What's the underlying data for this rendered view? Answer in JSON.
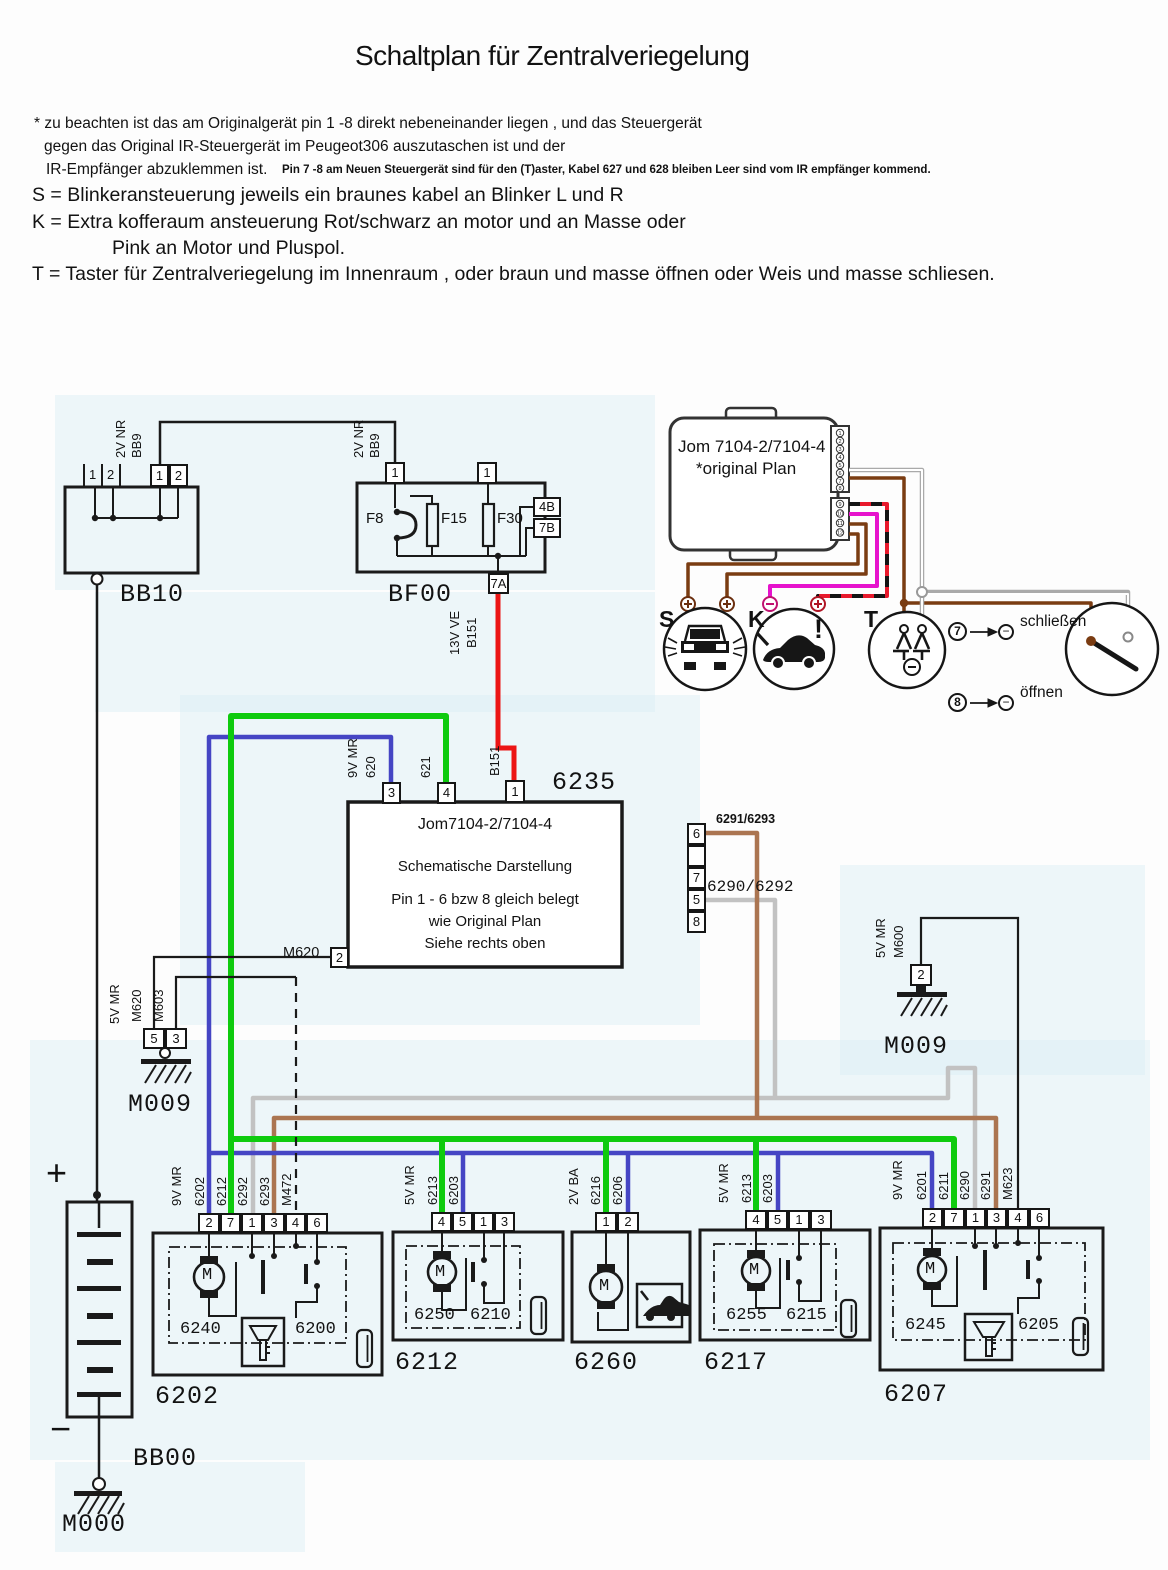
{
  "header": {
    "title": "Schaltplan für Zentralveriegelung",
    "note1": "* zu beachten ist das am Originalgerät pin 1 -8 direkt nebeneinander liegen , und das Steuergerät",
    "note2": "gegen das Original IR-Steuergerät im Peugeot306 auszutaschen ist und der",
    "note3": "IR-Empfänger abzuklemmen ist.",
    "note3b": "Pin 7 -8 am Neuen Steuergerät sind für den (T)aster, Kabel 627 und 628 bleiben Leer sind vom IR empfänger kommend.",
    "s_line": "S = Blinkeransteuerung jeweils ein braunes kabel an Blinker L und R",
    "k_line1": "K = Extra kofferaum ansteuerung Rot/schwarz an motor und an Masse oder",
    "k_line2": "Pink an Motor und  Pluspol.",
    "t_line": "T = Taster für Zentralveriegelung im Innenraum , oder braun und masse öffnen oder Weis und masse schliesen."
  },
  "bb10": {
    "label": "BB10",
    "tick1": "1",
    "tick2": "2",
    "pin1": "1",
    "pin2": "2",
    "w1": "2V NR",
    "w2": "BB9"
  },
  "bf00": {
    "label": "BF00",
    "f8": "F8",
    "f15": "F15",
    "f30": "F30",
    "pin_l": "1",
    "pin_r": "1",
    "p4b": "4B",
    "p7b": "7B",
    "p7a": "7A",
    "w1": "2V NR",
    "w2": "BB9",
    "out1": "13V VE",
    "out2": "B151"
  },
  "unit": {
    "title": "Jom 7104-2/7104-4",
    "subtitle": "*original Plan",
    "pt": [
      "1",
      "2",
      "3",
      "4",
      "5",
      "6",
      "7",
      "8"
    ],
    "pb": [
      "9",
      "10",
      "11",
      "12"
    ],
    "s": "S",
    "k": "K",
    "t": "T",
    "excl": "!",
    "n7": "7",
    "n8": "8",
    "minus": "−",
    "close": "schließen",
    "open": "öffnen"
  },
  "u6235": {
    "num": "6235",
    "l1": "Jom7104-2/7104-4",
    "l2": "Schematische Darstellung",
    "l3": "Pin 1 - 6 bzw 8 gleich belegt",
    "l4": "wie Original Plan",
    "l5": "Siehe rechts oben",
    "p3": "3",
    "p4": "4",
    "p1": "1",
    "p2": "2",
    "p6": "6",
    "p7": "7",
    "p5": "5",
    "p8": "8",
    "v9": "9V MR",
    "w620": "620",
    "w621": "621",
    "wb151": "B151",
    "m620": "M620",
    "r1": "6291/6293",
    "r2": "6290/6292"
  },
  "gl": {
    "v": "5V MR",
    "m620": "M620",
    "m603": "M603",
    "p5": "5",
    "p3": "3",
    "name": "M009"
  },
  "gr": {
    "v": "5V MR",
    "m600": "M600",
    "p2": "2",
    "name": "M009"
  },
  "bat": {
    "plus": "+",
    "minus": "−",
    "bb00": "BB00",
    "m000": "M000"
  },
  "boxes": [
    {
      "volt": "9V MR",
      "wires": [
        "6202",
        "6212",
        "6292",
        "6293",
        "M472"
      ],
      "pins": [
        "2",
        "7",
        "1",
        "3",
        "4",
        "6"
      ],
      "inner": [
        "6240",
        "6200"
      ],
      "label": "6202"
    },
    {
      "volt": "5V MR",
      "wires": [
        "6213",
        "6203"
      ],
      "pins": [
        "4",
        "5",
        "1",
        "3"
      ],
      "inner": [
        "6250",
        "6210"
      ],
      "label": "6212"
    },
    {
      "volt": "2V BA",
      "wires": [
        "6216",
        "6206"
      ],
      "pins": [
        "1",
        "2"
      ],
      "inner": [],
      "label": "6260"
    },
    {
      "volt": "5V MR",
      "wires": [
        "6213",
        "6203"
      ],
      "pins": [
        "4",
        "5",
        "1",
        "3"
      ],
      "inner": [
        "6255",
        "6215"
      ],
      "label": "6217"
    },
    {
      "volt": "9V MR",
      "wires": [
        "6201",
        "6211",
        "6290",
        "6291",
        "M623"
      ],
      "pins": [
        "2",
        "7",
        "1",
        "3",
        "4",
        "6"
      ],
      "inner": [
        "6245",
        "6205"
      ],
      "label": "6207"
    }
  ],
  "colors": {
    "blue": "#4545c4",
    "green": "#0ecb0e",
    "red": "#ec1515",
    "brown_bus": "#ab7551",
    "dark_brown": "#7a3c12",
    "magenta": "#e612cc",
    "gray": "#c2c2c2",
    "black": "#1a1a1a"
  }
}
